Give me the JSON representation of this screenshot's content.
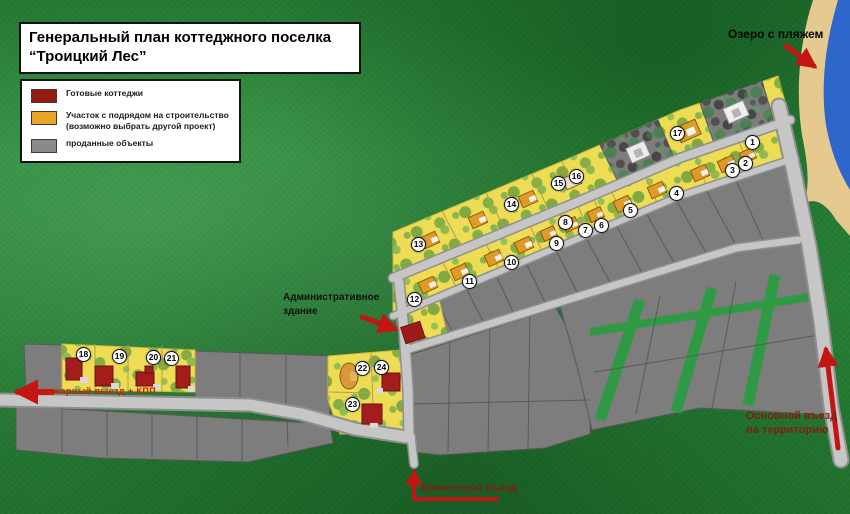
{
  "title": {
    "line1": "Генеральный план коттеджного поселка",
    "line2": "“Троицкий Лес”"
  },
  "legend": {
    "items": [
      {
        "label": "Готовые коттеджи",
        "sublabel": "",
        "color": "#931a15"
      },
      {
        "label": "Участок с подрядом на строительство",
        "sublabel": "(возможно выбрать другой проект)",
        "color": "#e7a725"
      },
      {
        "label": "проданные объекты",
        "sublabel": "",
        "color": "#8a8a8a"
      }
    ]
  },
  "labels": {
    "lake": "Озеро с пляжем",
    "admin_line1": "Административное",
    "admin_line2": "здание",
    "main_entrance_line1": "Основной въезд",
    "main_entrance_line2": "на территорию",
    "temporary_entrance": "Временный въезд",
    "fire_exit": "пожарный выезд + КПП"
  },
  "plots": [
    {
      "num": "1",
      "x": 753,
      "y": 143
    },
    {
      "num": "2",
      "x": 746,
      "y": 164
    },
    {
      "num": "3",
      "x": 733,
      "y": 171
    },
    {
      "num": "4",
      "x": 677,
      "y": 194
    },
    {
      "num": "5",
      "x": 631,
      "y": 211
    },
    {
      "num": "6",
      "x": 602,
      "y": 226
    },
    {
      "num": "7",
      "x": 586,
      "y": 231
    },
    {
      "num": "8",
      "x": 566,
      "y": 223
    },
    {
      "num": "9",
      "x": 557,
      "y": 244
    },
    {
      "num": "10",
      "x": 512,
      "y": 263
    },
    {
      "num": "11",
      "x": 470,
      "y": 282
    },
    {
      "num": "12",
      "x": 415,
      "y": 300
    },
    {
      "num": "13",
      "x": 419,
      "y": 245
    },
    {
      "num": "14",
      "x": 512,
      "y": 205
    },
    {
      "num": "15",
      "x": 559,
      "y": 184
    },
    {
      "num": "16",
      "x": 577,
      "y": 177
    },
    {
      "num": "17",
      "x": 678,
      "y": 134
    },
    {
      "num": "18",
      "x": 84,
      "y": 355
    },
    {
      "num": "19",
      "x": 120,
      "y": 357
    },
    {
      "num": "20",
      "x": 154,
      "y": 358
    },
    {
      "num": "21",
      "x": 172,
      "y": 359
    },
    {
      "num": "22",
      "x": 363,
      "y": 369
    },
    {
      "num": "23",
      "x": 353,
      "y": 405
    },
    {
      "num": "24",
      "x": 382,
      "y": 368
    }
  ],
  "colors": {
    "ready_cottage": "#931a15",
    "contract_plot": "#e7a725",
    "sold_plot": "#8a8a8a",
    "road": "#c6c6c6",
    "lake": "#2f66cc",
    "beach": "#e6c98e",
    "arrow": "#c41414"
  }
}
